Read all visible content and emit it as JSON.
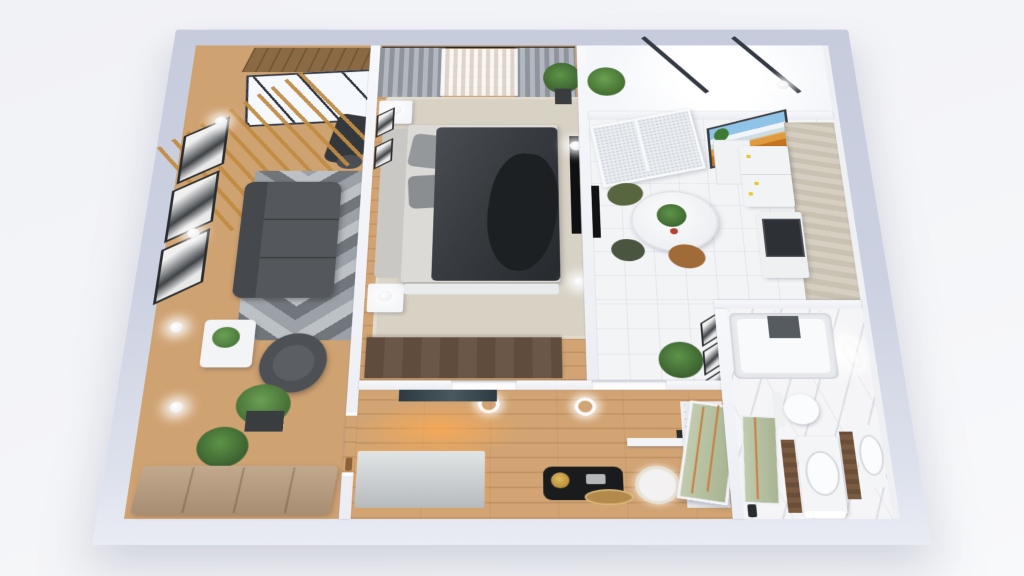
{
  "scene": {
    "title": "3D apartment floor plan render",
    "view": "isometric top-down",
    "background_color": "#f4f5f8",
    "exterior_wall_color": "#ccd1e1",
    "interior_wall_color": "#f4f5f9"
  },
  "palette": {
    "wood_floor": "#cfa271",
    "hall_wood_floor": "#d2a473",
    "white_tile": "#f3f4f6",
    "marble": "#f5f5f7",
    "wood_slats": "#c08c42",
    "sofa_gray": "#54575b",
    "duvet_dark": "#34383d",
    "rug_beige": "#d8d2c4",
    "rug_gray": "#9ba1a7",
    "wardrobe_brown": "#5f4c3d",
    "stone_cabinet": "#cfc7b9",
    "green_glass": "#b4bf9e",
    "copper_trim": "#c87c3e",
    "gold_decor": "#c59a3d",
    "plant_green": "#4e8040",
    "warm_glow": "#ffaa50"
  },
  "rooms": {
    "living_room": {
      "name": "Living room",
      "furniture": [
        "wood slat screen",
        "skylight window",
        "wood ceiling strip",
        "exercise machine",
        "gallery wall frames",
        "wall sconces",
        "gray sofa",
        "chevron rug",
        "armchair",
        "coffee table with plant",
        "potted plants",
        "beige bench seats",
        "wood floor"
      ]
    },
    "bedroom": {
      "name": "Bedroom",
      "furniture": [
        "curtain rod",
        "gray curtains",
        "sheer curtain",
        "double bed with dark duvet",
        "headboard",
        "pillows",
        "beige rug",
        "nightstands with lamps",
        "dark wardrobe",
        "wall TV",
        "plant",
        "small frames"
      ]
    },
    "balcony": {
      "name": "Balcony",
      "furniture": [
        "skylight with dark beams",
        "plant"
      ]
    },
    "kitchen": {
      "name": "Kitchen",
      "furniture": [
        "frosted glass door",
        "mountain landscape painting",
        "white cabinet",
        "fridge with magnets",
        "oven",
        "stone cabinet wall",
        "round marble table",
        "plant centerpiece",
        "green chair",
        "tan chair",
        "wall TV"
      ]
    },
    "hallway": {
      "name": "Hallway",
      "furniture": [
        "white sideboard with warm glow",
        "dark artwork",
        "black console",
        "gold medallion",
        "brass tray",
        "round mirror",
        "floating shelf",
        "ring downlights",
        "hex tile entry",
        "green glass front door"
      ]
    },
    "bathroom": {
      "name": "Bathroom",
      "furniture": [
        "bathtub",
        "dark bath screen",
        "toilet",
        "green shower glass",
        "walnut panels",
        "double vanity sinks",
        "wall light",
        "ceiling light",
        "marble floor"
      ]
    }
  }
}
